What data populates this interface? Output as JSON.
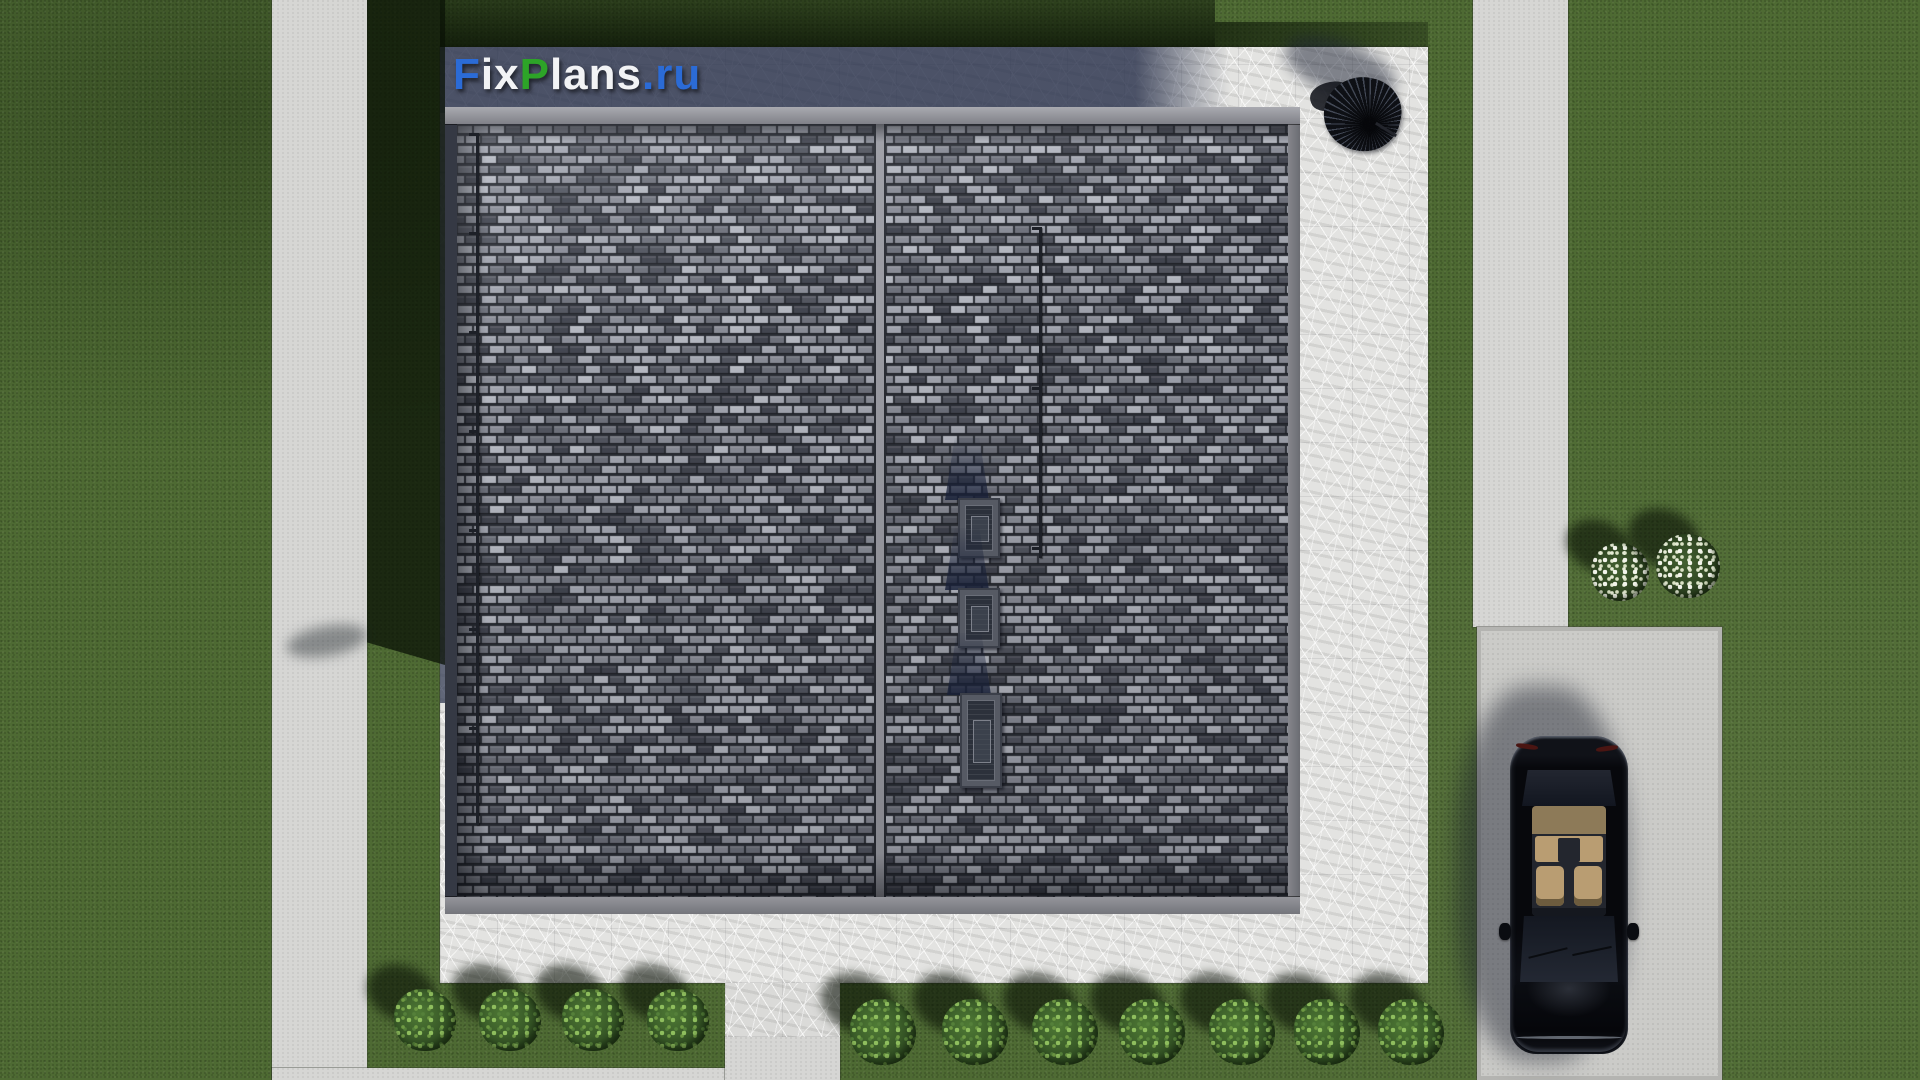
{
  "watermark": {
    "text": "FixPlans.ru",
    "segments": [
      {
        "text": "F",
        "color": "#2b6bd6"
      },
      {
        "text": "ix",
        "color": "#f2f3f5"
      },
      {
        "text": "P",
        "color": "#2da428"
      },
      {
        "text": "lans",
        "color": "#f2f3f5"
      },
      {
        "text": ".ru",
        "color": "#2b6bd6"
      }
    ]
  },
  "palette": {
    "grass": "#4e6a33",
    "grass_shadow": "#1c2a12",
    "path_concrete": "#d6d6d4",
    "driveway": "#cbcbc8",
    "pad_concrete": "#e3e3e1",
    "pad_shadowed": "#3f4a6c",
    "roof_tile_light": "#a1a4ae",
    "roof_tile_dark": "#42454f",
    "car_body": "#07080c",
    "car_interior": "#b99d72",
    "bush_green": "#4f7a35",
    "flower_white": "#f2f4ea"
  },
  "scene": {
    "description": "Top-down 3D render of a hip-less dual-panel tiled roof house on a concrete pad, lawn, walkways, parked black car on driveway, patio umbrella, ornamental bushes",
    "roof": {
      "tile_rows_height_px": 10,
      "tile_width_px": 16,
      "skylights": [
        {
          "x": 958,
          "y": 498,
          "w": 42,
          "h": 60
        },
        {
          "x": 958,
          "y": 588,
          "w": 42,
          "h": 60
        },
        {
          "x": 960,
          "y": 693,
          "w": 42,
          "h": 95
        }
      ],
      "rods": [
        {
          "x": 476,
          "y1": 133,
          "y2": 825,
          "hook_gap": 99
        },
        {
          "x": 1039,
          "y1": 227,
          "y2": 558,
          "hook_gap": 160
        }
      ]
    },
    "bushes_left_row": {
      "y": 1020,
      "r": 31,
      "x": [
        425,
        510,
        593,
        678
      ]
    },
    "bushes_right_row": {
      "y": 1032,
      "r": 33,
      "x": [
        883,
        975,
        1065,
        1152,
        1242,
        1327,
        1411
      ]
    },
    "flower_bushes": [
      {
        "x": 1620,
        "y": 572,
        "r": 29
      },
      {
        "x": 1688,
        "y": 566,
        "r": 32
      }
    ],
    "wipers": [
      {
        "x": 1528,
        "y": 952,
        "rot": -14
      },
      {
        "x": 1572,
        "y": 950,
        "rot": -12
      }
    ],
    "mirrors": [
      {
        "x": 1499,
        "y": 923
      },
      {
        "x": 1627,
        "y": 923
      }
    ],
    "taillights": [
      {
        "x": 1516,
        "y": 744,
        "rot": 8
      },
      {
        "x": 1596,
        "y": 746,
        "rot": -8
      }
    ]
  }
}
